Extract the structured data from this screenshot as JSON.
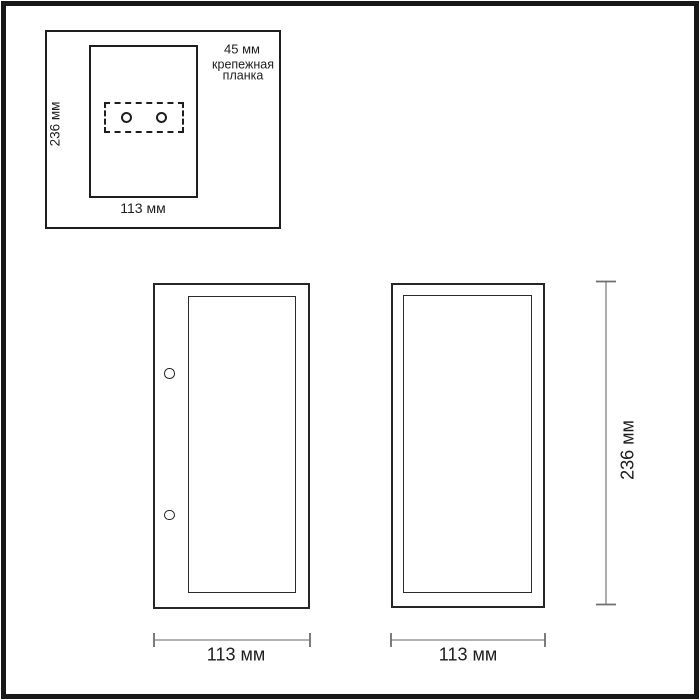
{
  "inset": {
    "height_label": "236 мм",
    "width_label": "113 мм",
    "hole_spacing_label": "45 мм",
    "bracket_label_line1": "крепежная",
    "bracket_label_line2": "планка"
  },
  "front_view": {
    "width_label": "113 мм"
  },
  "side_view": {
    "width_label": "113 мм",
    "height_label": "236 мм"
  },
  "colors": {
    "outline": "#1e1e1e",
    "dim_line": "#9a9a9a",
    "dim_tick": "#6e6e6e",
    "leader_line": "#3a3a3a",
    "text": "#1d1d1d",
    "frame": "#171717",
    "background": "#ffffff"
  }
}
